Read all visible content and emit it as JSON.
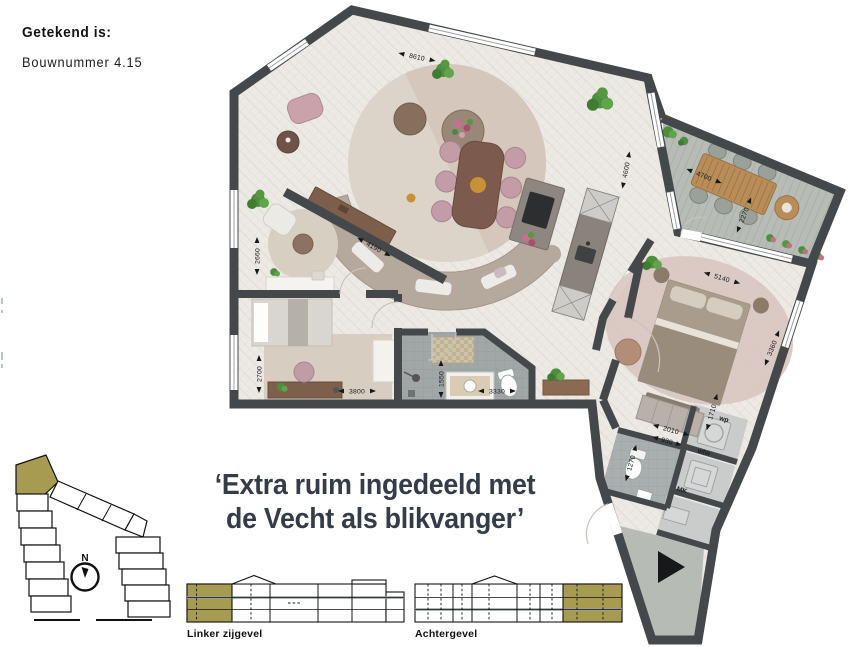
{
  "header": {
    "drawn_label": "Getekend is:",
    "unit_label": "Bouwnummer 4.15"
  },
  "quote": {
    "line1": "‘Extra ruim ingedeeld met",
    "line2": "de Vecht als blikvanger’"
  },
  "floorplan": {
    "dims": {
      "top": "8610",
      "living_window": "4600",
      "living_diagonal": "4190",
      "balcony_width": "4700",
      "balcony_depth": "2270",
      "bedroom_width": "5140",
      "bedroom_depth": "3360",
      "study_depth": "2660",
      "bedroom2_depth": "2700",
      "bedroom2_width": "3800",
      "bath_depth": "1550",
      "bath_width": "3330",
      "hall_width": "2010",
      "wc_width": "930",
      "wc_depth": "1270",
      "wp_depth": "1710"
    },
    "rooms": {
      "wp": "wp",
      "wtw": "wtw",
      "mk": "MK"
    }
  },
  "siteplan": {
    "north": "N"
  },
  "elevations": {
    "left": {
      "label": "Linker zijgevel"
    },
    "back": {
      "label": "Achtergevel"
    }
  },
  "colors": {
    "accent_olive": "#a79b52",
    "wall": "#45484b",
    "balcony": "#b7bcb6",
    "quote_text": "#343c49"
  }
}
